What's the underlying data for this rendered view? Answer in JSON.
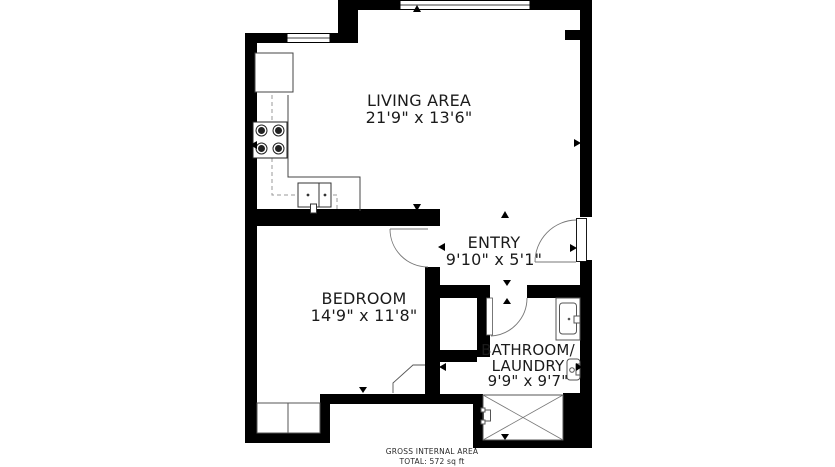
{
  "title": "Apartment floor plan",
  "rooms": {
    "living": {
      "name": "LIVING AREA",
      "dims": "21'9\" x 13'6\""
    },
    "entry": {
      "name": "ENTRY",
      "dims": "9'10\" x 5'1\""
    },
    "bedroom": {
      "name": "BEDROOM",
      "dims": "14'9\" x 11'8\""
    },
    "bathroom": {
      "name1": "BATHROOM/",
      "name2": "LAUNDRY",
      "dims": "9'9\" x 9'7\""
    }
  },
  "footer": {
    "line1": "GROSS INTERNAL AREA",
    "line2": "TOTAL: 572 sq ft"
  },
  "colors": {
    "walls": "#000000",
    "floor": "#ffffff",
    "fixture_line": "#555555",
    "swing_line": "#777777",
    "counter_line": "#444444"
  },
  "fixtures": [
    "fridge-icon",
    "stove-icon",
    "kitchen-sink-icon",
    "closet-icon",
    "entry-door-swing-icon",
    "bedroom-door-swing-icon",
    "bathroom-door-swing-icon",
    "vanity-sink-icon",
    "toilet-icon",
    "shower-washer-icon",
    "window-icon"
  ]
}
